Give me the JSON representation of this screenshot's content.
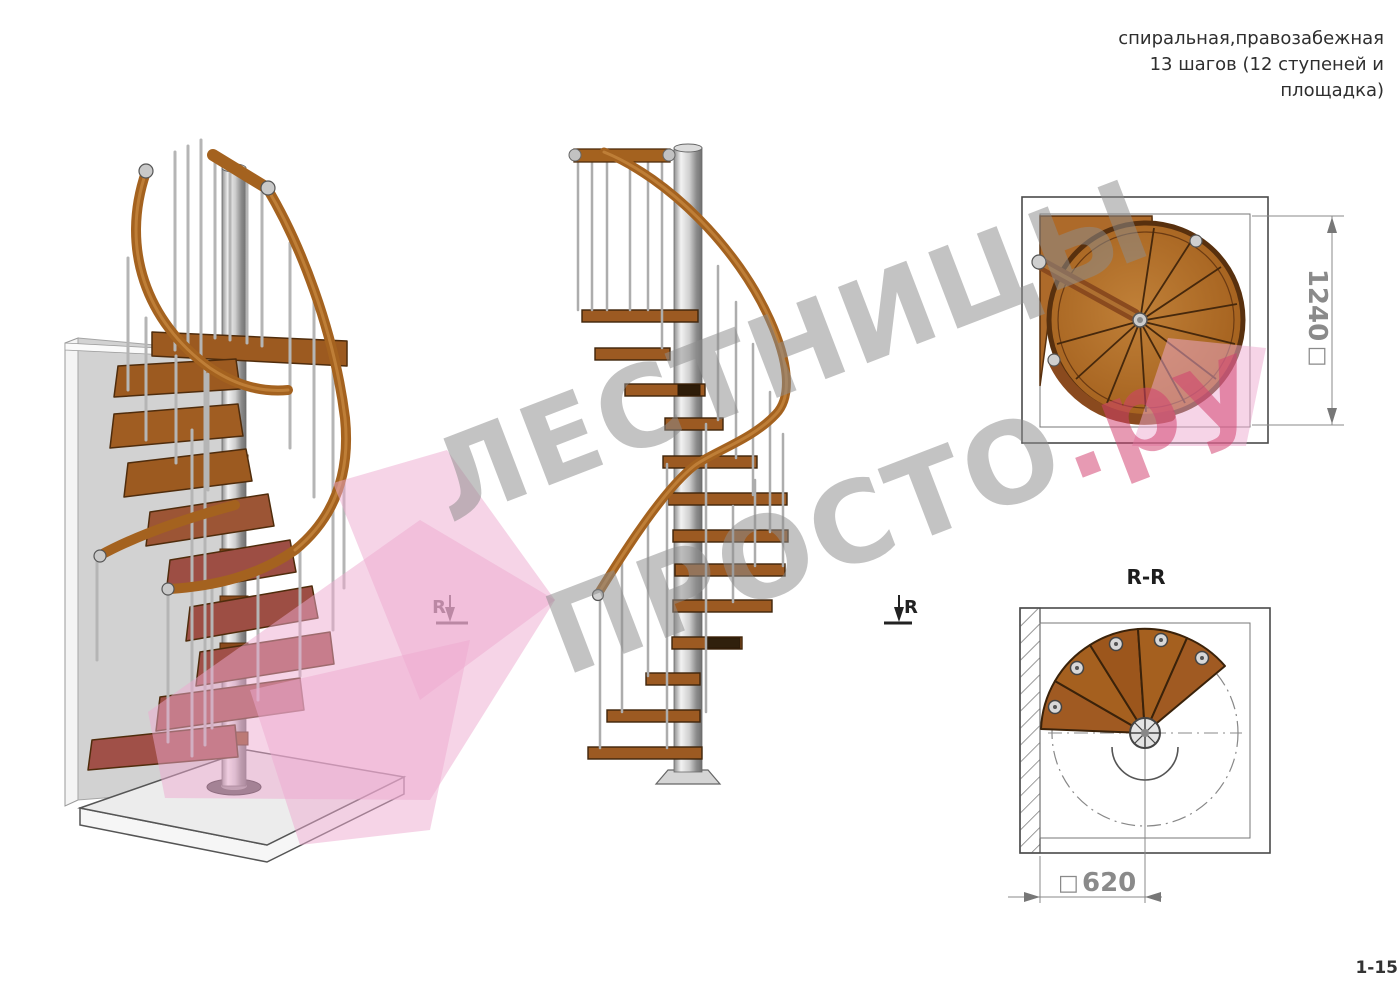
{
  "title": {
    "line1": "спиральная,правозабежная",
    "line2": "13 шагов (12 ступеней и",
    "line3": "площадка)"
  },
  "watermark": {
    "line1": "ЛЕСТНИЦЫ",
    "line2_gray": "ПРОСТО",
    "line2_red": ".ру",
    "gray_color": "#8d8d8d",
    "red_color": "#d23f6e"
  },
  "views": {
    "iso": {
      "marker_left": "R"
    },
    "elevation": {
      "marker_right": "R"
    },
    "plan": {
      "dim_symbol": "□",
      "dim_value": "1240"
    },
    "section": {
      "label": "R-R",
      "dim_symbol": "□",
      "dim_value": "620"
    }
  },
  "page_number": "1-15",
  "colors": {
    "wood": "#9c5a20",
    "wood_dark": "#4f2c0c",
    "rail_wood": "#a4621f",
    "steel": "#bdbdbd",
    "wall": "#d2d2d2",
    "floor": "#ececec",
    "pink": "#eeaacf",
    "outline": "#4a4a4a",
    "dim": "#8a8a8a"
  }
}
